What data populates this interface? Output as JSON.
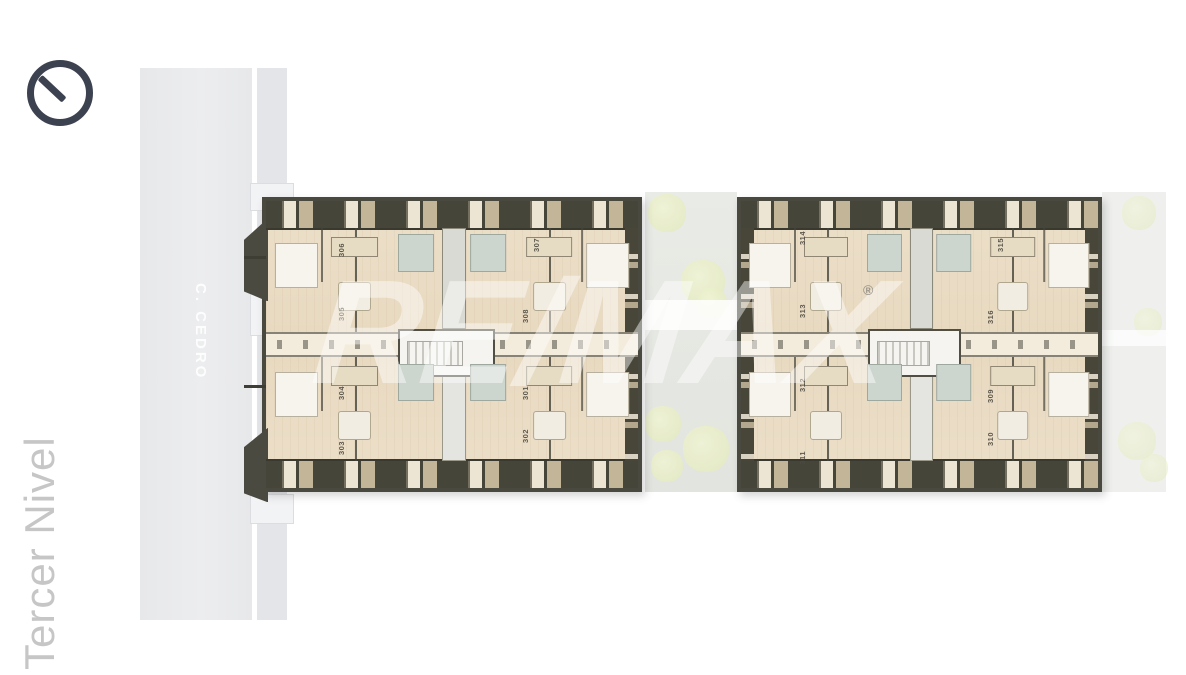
{
  "page": {
    "level_label": "Tercer Nivel",
    "street_label": "C. CEDRO"
  },
  "watermark": {
    "brand": "RE/MAX",
    "registered": "®"
  },
  "blocks": {
    "left": {
      "units": [
        {
          "number": "306"
        },
        {
          "number": "305"
        },
        {
          "number": "307"
        },
        {
          "number": "308"
        },
        {
          "number": "304"
        },
        {
          "number": "303"
        },
        {
          "number": "301"
        },
        {
          "number": "302"
        }
      ]
    },
    "right": {
      "units": [
        {
          "number": "314"
        },
        {
          "number": "313"
        },
        {
          "number": "315"
        },
        {
          "number": "316"
        },
        {
          "number": "312"
        },
        {
          "number": "311"
        },
        {
          "number": "309"
        },
        {
          "number": "310"
        }
      ]
    }
  },
  "colors": {
    "wall_dark": "#46453a",
    "floor_cream": "#ecdfc9",
    "street_gray": "#e9eaec",
    "tree_green": "#e7ecc6",
    "bath_accent": "#ccd5ce",
    "compass_dark": "#3c4250",
    "title_gray": "#c6c6c6",
    "watermark_white": "rgba(255,255,255,0.45)"
  }
}
